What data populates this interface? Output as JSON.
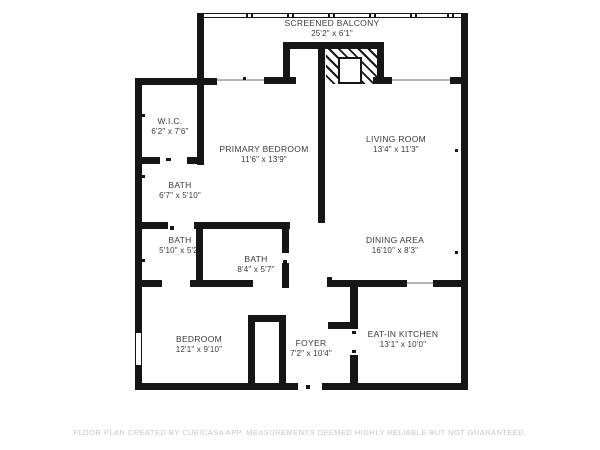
{
  "floor_plan": {
    "rooms": [
      {
        "name": "SCREENED BALCONY",
        "dims": "25'2\" x 6'1\""
      },
      {
        "name": "W.I.C.",
        "dims": "6'2\" x 7'6\""
      },
      {
        "name": "PRIMARY BEDROOM",
        "dims": "11'6\" x 13'9\""
      },
      {
        "name": "LIVING ROOM",
        "dims": "13'4\" x 11'3\""
      },
      {
        "name": "BATH",
        "dims": "6'7\" x 5'10\""
      },
      {
        "name": "BATH",
        "dims": "5'10\" x 5'2\""
      },
      {
        "name": "BATH",
        "dims": "8'4\" x 5'7\""
      },
      {
        "name": "DINING AREA",
        "dims": "16'10\" x 8'3\""
      },
      {
        "name": "BEDROOM",
        "dims": "12'1\" x 9'10\""
      },
      {
        "name": "FOYER",
        "dims": "7'2\" x 10'4\""
      },
      {
        "name": "EAT-IN KITCHEN",
        "dims": "13'1\" x 10'0\""
      }
    ],
    "footer": "FLOOR PLAN CREATED BY CUBICASA APP. MEASUREMENTS DEEMED HIGHLY RELIABLE BUT NOT GUARANTEED.",
    "colors": {
      "wall": "#161616",
      "text": "#3a3a3a",
      "footer_text": "#c6c6c6",
      "background": "#ffffff"
    }
  }
}
